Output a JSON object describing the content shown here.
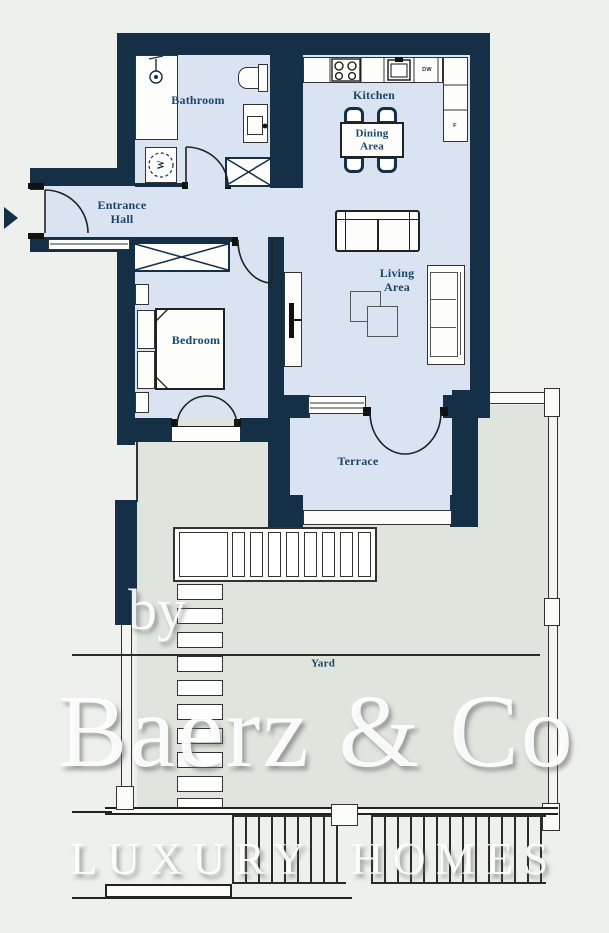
{
  "labels": {
    "bathroom": "Bathroom",
    "kitchen": "Kitchen",
    "dining": "Dining\nArea",
    "entrance": "Entrance\nHall",
    "living": "Living\nArea",
    "bedroom": "Bedroom",
    "terrace": "Terrace",
    "yard": "Yard"
  },
  "appliances": {
    "dishwasher": "DW",
    "fridge": "F",
    "washer": "W"
  },
  "watermark": {
    "prefix": "by",
    "brand": "Baerz & Co",
    "tagline": "LUXURY HOMES"
  },
  "colors": {
    "wall": "#152f47",
    "floor": "#d9e3f1",
    "yard": "#dfe5dd",
    "background": "#eef0ed",
    "label": "#1a4663",
    "line": "#2b2b2b"
  }
}
